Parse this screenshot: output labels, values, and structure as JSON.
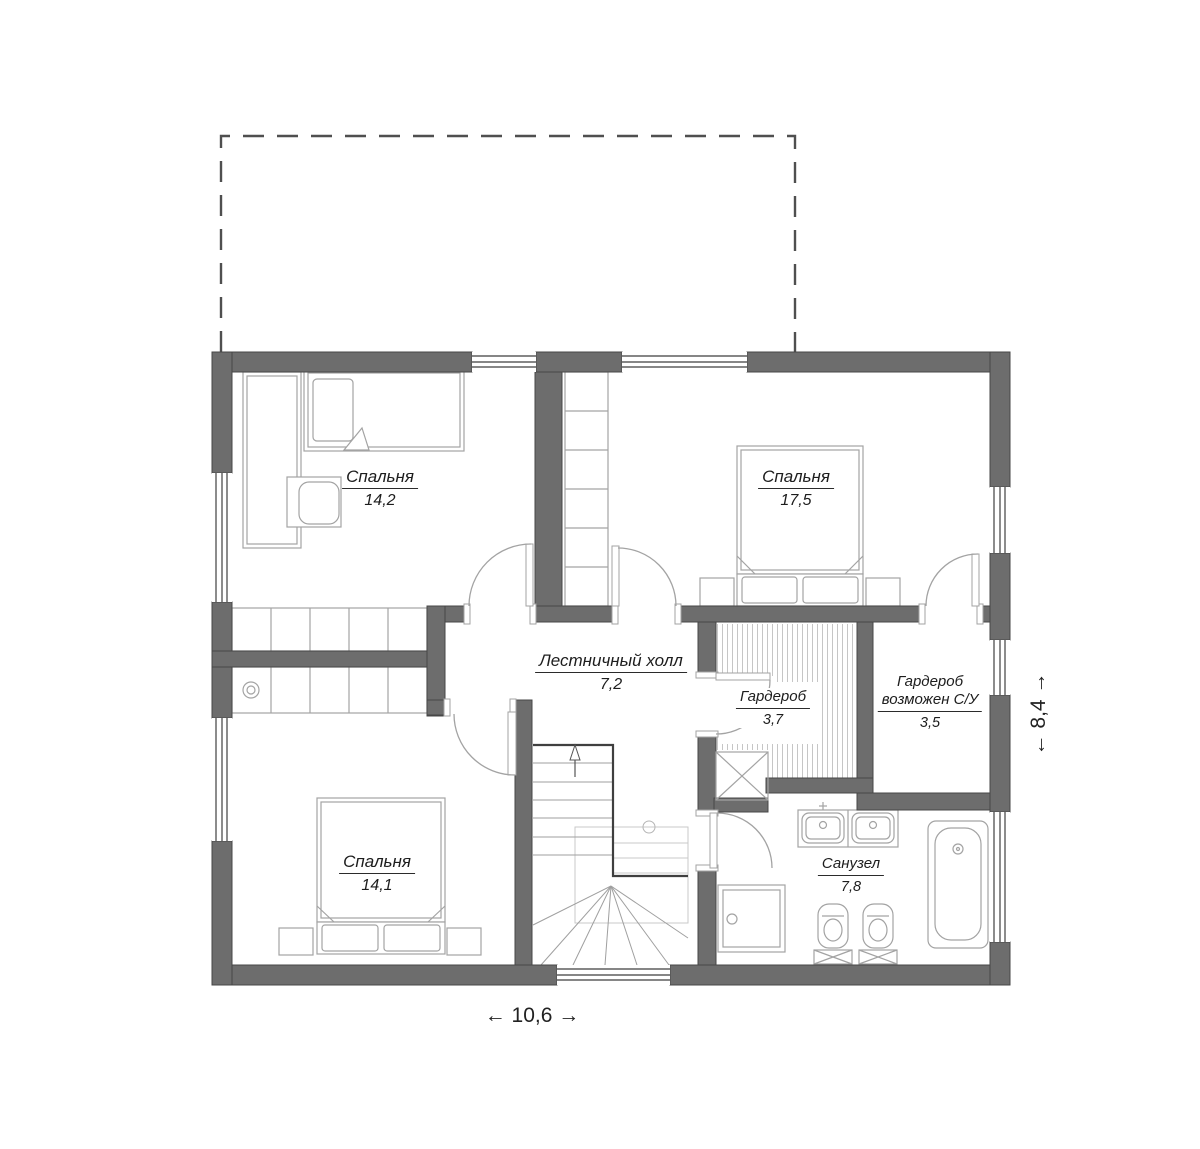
{
  "plan": {
    "rooms": [
      {
        "id": "bedroom-top-left",
        "name": "Спальня",
        "area": "14,2"
      },
      {
        "id": "bedroom-top-right",
        "name": "Спальня",
        "area": "17,5"
      },
      {
        "id": "bedroom-bottom-left",
        "name": "Спальня",
        "area": "14,1"
      },
      {
        "id": "stair-hall",
        "name": "Лестничный холл",
        "area": "7,2"
      },
      {
        "id": "wardrobe",
        "name": "Гардероб",
        "area": "3,7"
      },
      {
        "id": "wardrobe-possible-su",
        "name": "Гардероб",
        "name2": "возможен С/У",
        "area": "3,5"
      },
      {
        "id": "bathroom",
        "name": "Санузел",
        "area": "7,8"
      }
    ],
    "dimensions": {
      "width": "← 10,6 →",
      "height": "← 8,4 →"
    },
    "colors": {
      "wall": "#6d6d6d",
      "wall_edge": "#474747",
      "line_light": "#c9c9c9",
      "line_mid": "#a3a3a3",
      "line_dark": "#3f3f3f",
      "dashed": "#4f4f4f",
      "text": "#1d1d1d"
    }
  }
}
